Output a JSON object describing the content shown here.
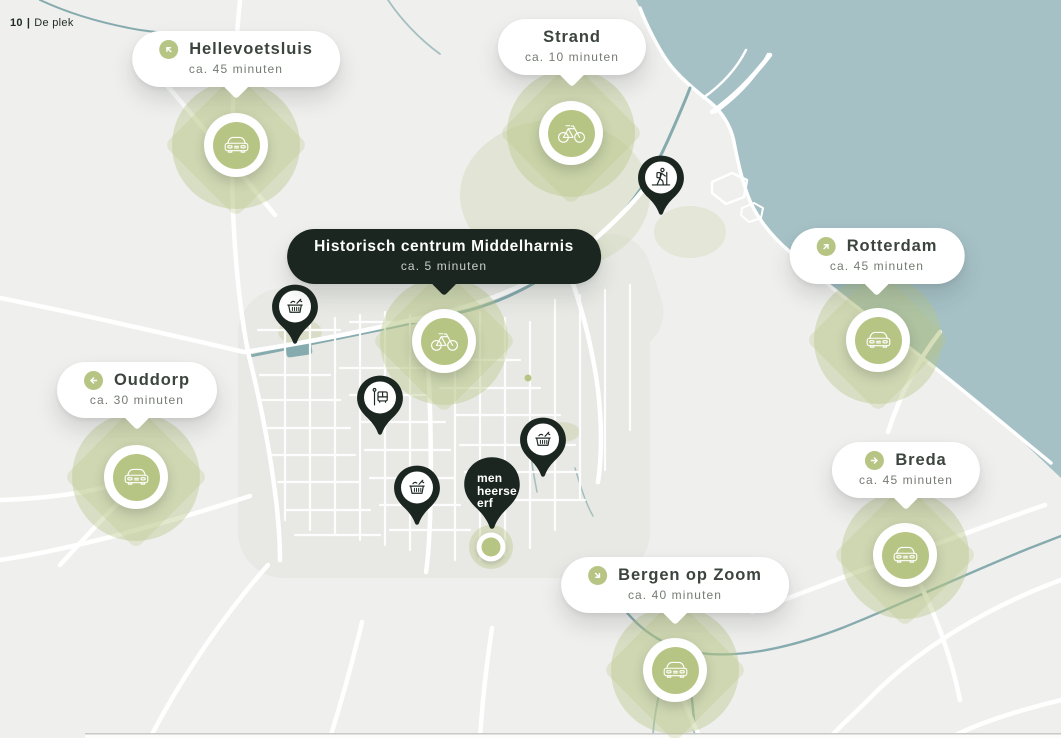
{
  "page": {
    "number": "10",
    "divider": "|",
    "section": "De plek"
  },
  "home": {
    "brand_lines": [
      "men",
      "heerse",
      "erf"
    ]
  },
  "destinations": [
    {
      "name": "Hellevoetsluis",
      "time": "ca. 45 minuten",
      "direction": "northwest",
      "transport": "car",
      "style": "light"
    },
    {
      "name": "Strand",
      "time": "ca. 10 minuten",
      "direction": "",
      "transport": "bike",
      "style": "light"
    },
    {
      "name": "Historisch centrum Middelharnis",
      "time": "ca. 5 minuten",
      "direction": "",
      "transport": "bike",
      "style": "dark"
    },
    {
      "name": "Rotterdam",
      "time": "ca. 45 minuten",
      "direction": "northeast",
      "transport": "car",
      "style": "light"
    },
    {
      "name": "Ouddorp",
      "time": "ca. 30 minuten",
      "direction": "west",
      "transport": "car",
      "style": "light"
    },
    {
      "name": "Breda",
      "time": "ca. 45 minuten",
      "direction": "east",
      "transport": "car",
      "style": "light"
    },
    {
      "name": "Bergen op Zoom",
      "time": "ca. 40 minuten",
      "direction": "southeast",
      "transport": "car",
      "style": "light"
    }
  ],
  "poi_pins": [
    {
      "type": "hiking-trail"
    },
    {
      "type": "supermarket"
    },
    {
      "type": "bus-stop"
    },
    {
      "type": "supermarket"
    },
    {
      "type": "supermarket"
    }
  ],
  "icons": {
    "car": "car-front-icon",
    "bike": "bicycle-icon",
    "hiker": "hiker-icon",
    "basket": "shopping-basket-icon",
    "bus": "bus-stop-icon",
    "arrow": "direction-arrow-icon"
  },
  "colors": {
    "sea": "#a5c1c6",
    "land": "#efefed",
    "sage": "#b7c584",
    "pin_dark": "#1b2620",
    "white": "#ffffff"
  }
}
